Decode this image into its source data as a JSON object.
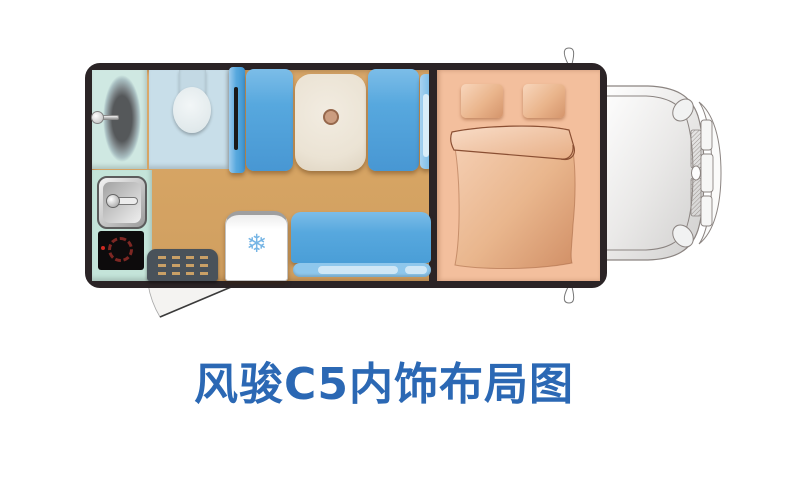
{
  "title": {
    "text": "风骏C5内饰布局图",
    "color": "#2b68b4"
  },
  "icons": {
    "snowflake": {
      "glyph": "❄",
      "color": "#76b5e5"
    }
  },
  "diagram": {
    "type": "rv-interior-floorplan",
    "vehicle": "风骏C5"
  },
  "colors": {
    "body_outline": "#2b2426",
    "floor_tan": "#d7a564",
    "seat_blue": "#57a8de",
    "seat_blue_light": "#8ec7ec",
    "bed_salmon": "#f3bf9d",
    "shower_teal": "#cfe8e2",
    "toilet_blue": "#c8dee9",
    "kitchen_mint": "#c4e4d9",
    "table_cream": "#ece4d6",
    "mat_gray": "#49525a",
    "cab_line_gray": "#8b8481"
  }
}
